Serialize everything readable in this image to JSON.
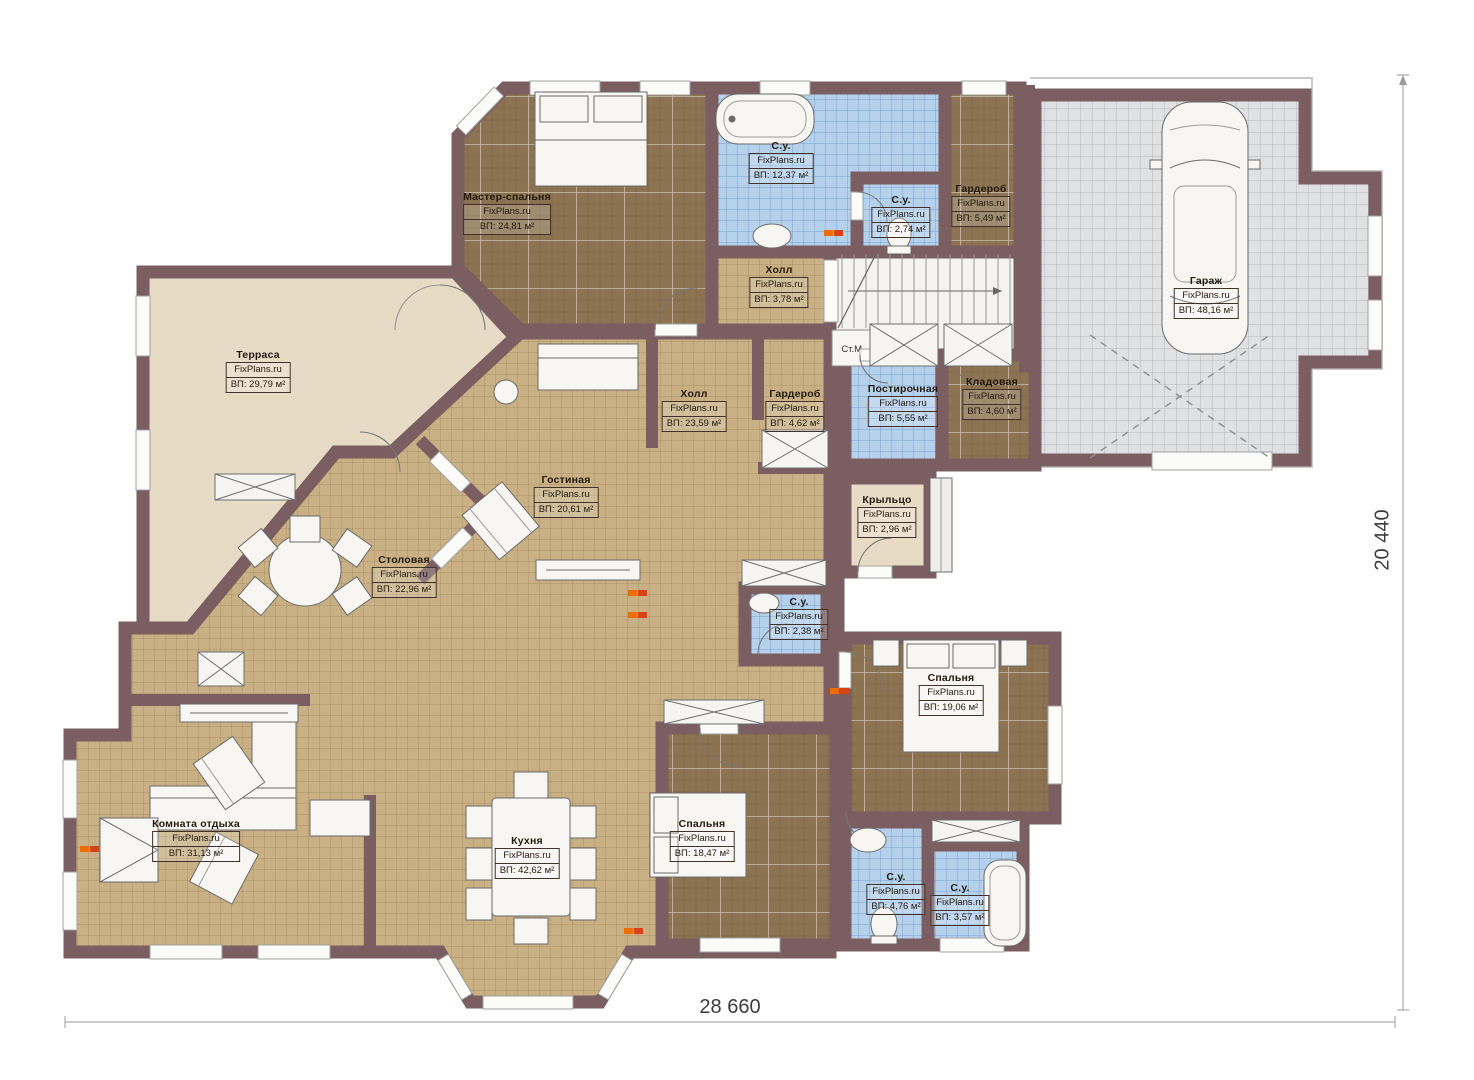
{
  "brand": "FixPlans.ru",
  "dimensions": {
    "bottom": "28 660",
    "right": "20 440"
  },
  "fixtures": {
    "washer_label": "Ст.М."
  },
  "colors": {
    "wall": "#7a5e61",
    "floor_tan": "#c9b185",
    "floor_dark": "#8c7351",
    "floor_blue": "#b5d1ec",
    "terrace": "#e8dbc6",
    "garage": "#e0e1e3",
    "radiator": "#ef6c00"
  },
  "rooms": [
    {
      "name": "Мастер-спальня",
      "area": "ВП: 24,81 м²"
    },
    {
      "name": "С.у.",
      "area": "ВП: 12,37 м²"
    },
    {
      "name": "С.у.",
      "area": "ВП: 2,74 м²"
    },
    {
      "name": "Гардероб",
      "area": "ВП: 5,49 м²"
    },
    {
      "name": "Гараж",
      "area": "ВП: 48,16 м²"
    },
    {
      "name": "Холл",
      "area": "ВП: 3,78 м²"
    },
    {
      "name": "Терраса",
      "area": "ВП: 29,79 м²"
    },
    {
      "name": "Холл",
      "area": "ВП: 23,59 м²"
    },
    {
      "name": "Гардероб",
      "area": "ВП: 4,62 м²"
    },
    {
      "name": "Постирочная",
      "area": "ВП: 5,55 м²"
    },
    {
      "name": "Кладовая",
      "area": "ВП: 4,60 м²"
    },
    {
      "name": "Гостиная",
      "area": "ВП: 20,61 м²"
    },
    {
      "name": "Крыльцо",
      "area": "ВП: 2,96 м²"
    },
    {
      "name": "Столовая",
      "area": "ВП: 22,96 м²"
    },
    {
      "name": "С.у.",
      "area": "ВП: 2,38 м²"
    },
    {
      "name": "Спальня",
      "area": "ВП: 19,06 м²"
    },
    {
      "name": "Комната отдыха",
      "area": "ВП: 31,13 м²"
    },
    {
      "name": "Кухня",
      "area": "ВП: 42,62 м²"
    },
    {
      "name": "Спальня",
      "area": "ВП: 18,47 м²"
    },
    {
      "name": "С.у.",
      "area": "ВП: 4,76 м²"
    },
    {
      "name": "С.у.",
      "area": "ВП: 3,57 м²"
    }
  ]
}
